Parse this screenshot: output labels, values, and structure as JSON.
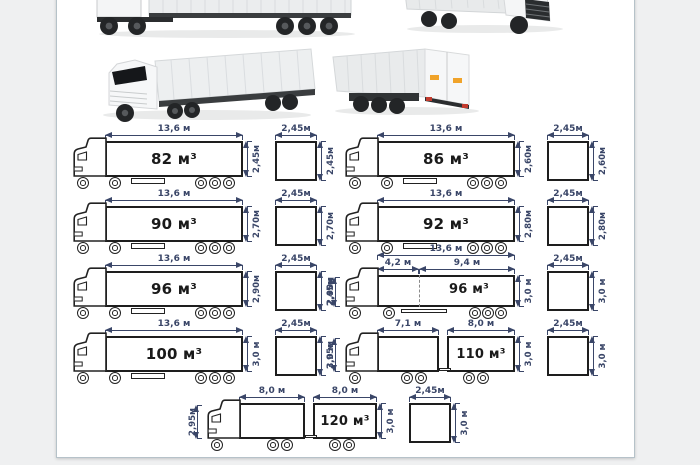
{
  "window": {
    "background": "#eff0f1",
    "panel_background": "#ffffff",
    "panel_border": "#b6c2c9"
  },
  "colors": {
    "dimension_lines": "#3a4668",
    "box_outline": "#1e1e1e",
    "volume_text": "#1a1a1a"
  },
  "photos": {
    "top_left": "semi-truck-side-view-photo",
    "top_right": "semi-truck-front-quarter-photo-cropped",
    "mid_left": "semi-truck-front-quarter-photo",
    "mid_right": "box-truck-rear-quarter-photo"
  },
  "diagrams": {
    "rows": [
      {
        "left": {
          "length": "13,6 м",
          "height": "2,45м",
          "volume": "82 м³",
          "cross_width": "2,45м",
          "cross_height": "2,45м"
        },
        "right": {
          "length": "13,6 м",
          "height": "2,60м",
          "volume": "86 м³",
          "cross_width": "2,45м",
          "cross_height": "2,60м"
        }
      },
      {
        "left": {
          "length": "13,6 м",
          "height": "2,70м",
          "volume": "90 м³",
          "cross_width": "2,45м",
          "cross_height": "2,70м"
        },
        "right": {
          "length": "13,6 м",
          "height": "2,80м",
          "volume": "92 м³",
          "cross_width": "2,45м",
          "cross_height": "2,80м"
        }
      },
      {
        "left": {
          "length": "13,6 м",
          "height": "2,90м",
          "volume": "96 м³",
          "cross_width": "2,45м",
          "cross_height": "2,90м"
        },
        "right": {
          "length": "13,6 м",
          "front_length": "4,2 м",
          "rear_length": "9,4 м",
          "cab_height": "2,45м",
          "height": "3,0 м",
          "volume": "96 м³",
          "cross_width": "2,45м",
          "cross_height": "3,0 м"
        }
      },
      {
        "left": {
          "length": "13,6 м",
          "height": "3,0 м",
          "volume": "100 м³",
          "cross_width": "2,45м",
          "cross_height": "3,0 м"
        },
        "right": {
          "front_length": "7,1 м",
          "rear_length": "8,0 м",
          "cab_height": "2,95м",
          "height": "3,0 м",
          "volume": "110 м³",
          "cross_width": "2,45м",
          "cross_height": "3,0 м"
        }
      },
      {
        "center": {
          "front_length": "8,0 м",
          "rear_length": "8,0 м",
          "cab_height": "2,95м",
          "height": "3,0 м",
          "volume": "120 м³",
          "cross_width": "2,45м",
          "cross_height": "3,0 м"
        }
      }
    ]
  }
}
